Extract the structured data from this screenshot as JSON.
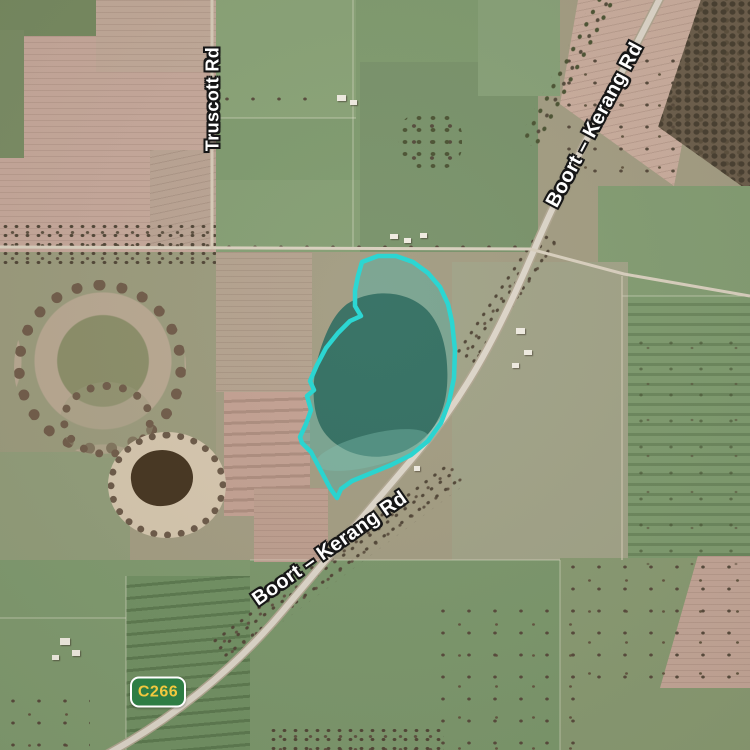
{
  "map": {
    "road_labels": [
      {
        "id": "truscott",
        "text": "Truscott Rd"
      },
      {
        "id": "boort-kerang-top",
        "text": "Boort – Kerang Rd"
      },
      {
        "id": "boort-kerang-bottom",
        "text": "Boort – Kerang Rd"
      }
    ],
    "route_shield": {
      "text": "C266",
      "bg": "#2e7d44",
      "border_color": "#ffffff",
      "text_color": "#f3c83e"
    },
    "highlighted_region": {
      "outline_points": "362,262 378,256 396,256 413,262 428,273 440,287 448,304 452,322 455,350 454,378 449,402 441,423 428,441 411,455 391,465 369,474 352,481 341,489 337,498 330,488 321,471 311,452 302,443 300,437 306,424 311,410 307,396 314,390 310,381 317,365 326,348 338,333 350,321 361,316 355,306 355,291 358,276",
      "stroke_color": "#24d6d2",
      "fill_color": "rgba(84,170,158,0.52)",
      "water_color": "#2d6a5e"
    },
    "label_style": {
      "text_color": "#ffffff",
      "outline_color": "#161616"
    }
  }
}
